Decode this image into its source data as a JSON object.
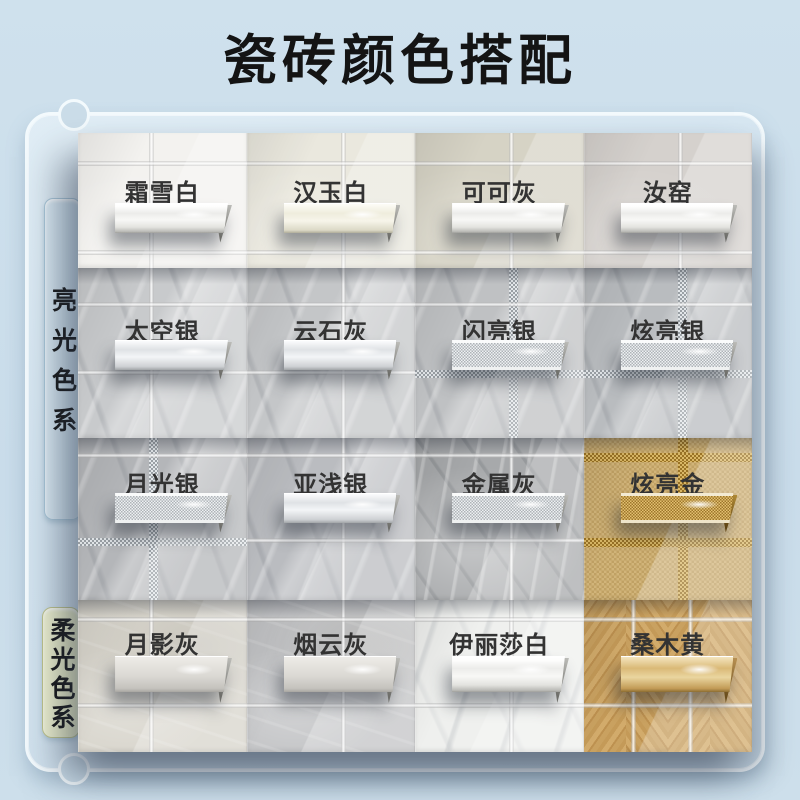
{
  "page": {
    "title": "瓷砖颜色搭配",
    "background": "#cbdde9"
  },
  "series": {
    "glossy": "亮光色系",
    "soft": "柔光色系"
  },
  "tiles": [
    {
      "name": "霜雪白",
      "base": "#f3f2ef",
      "finish": "亮光色系",
      "texture": "glossy-plain",
      "trim": "gloss-white"
    },
    {
      "name": "汉玉白",
      "base": "#eae8de",
      "finish": "亮光色系",
      "texture": "glossy-plain",
      "trim": "gloss-cream"
    },
    {
      "name": "可可灰",
      "base": "#d6d3c5",
      "finish": "亮光色系",
      "texture": "glossy-plain",
      "trim": "gloss-white"
    },
    {
      "name": "汝窑",
      "base": "#d5d1cd",
      "finish": "亮光色系",
      "texture": "glossy-plain",
      "trim": "gloss-white"
    },
    {
      "name": "太空银",
      "base": "#c8cacc",
      "finish": "亮光色系",
      "texture": "marble",
      "trim": "gloss-silver"
    },
    {
      "name": "云石灰",
      "base": "#c4c6c8",
      "finish": "亮光色系",
      "texture": "marble",
      "trim": "gloss-silver"
    },
    {
      "name": "闪亮银",
      "base": "#bfc1c3",
      "finish": "亮光色系",
      "texture": "marble",
      "trim": "glitter-silver"
    },
    {
      "name": "炫亮银",
      "base": "#b9bcbf",
      "finish": "亮光色系",
      "texture": "marble",
      "trim": "glitter-silver"
    },
    {
      "name": "月光银",
      "base": "#b4b6b9",
      "finish": "亮光色系",
      "texture": "marble",
      "trim": "glitter-silver"
    },
    {
      "name": "亚浅银",
      "base": "#babcc0",
      "finish": "亮光色系",
      "texture": "marble",
      "trim": "gloss-silver"
    },
    {
      "name": "金属灰",
      "base": "#a7a9ab",
      "finish": "亮光色系",
      "texture": "metal",
      "trim": "glitter-silver"
    },
    {
      "name": "炫亮金",
      "base": "#c8a96c",
      "finish": "亮光色系",
      "texture": "gold-sparkle",
      "trim": "glitter-gold"
    },
    {
      "name": "月影灰",
      "base": "#d7d4cb",
      "finish": "柔光色系",
      "texture": "stone",
      "trim": "matte-light"
    },
    {
      "name": "烟云灰",
      "base": "#c2c3c5",
      "finish": "柔光色系",
      "texture": "stone",
      "trim": "matte-light"
    },
    {
      "name": "伊丽莎白",
      "base": "#eff0ee",
      "finish": "柔光色系",
      "texture": "white-marble",
      "trim": "gloss-white"
    },
    {
      "name": "桑木黄",
      "base": "#c79e5f",
      "finish": "柔光色系",
      "texture": "wood-chevron",
      "trim": "gloss-tan"
    }
  ]
}
